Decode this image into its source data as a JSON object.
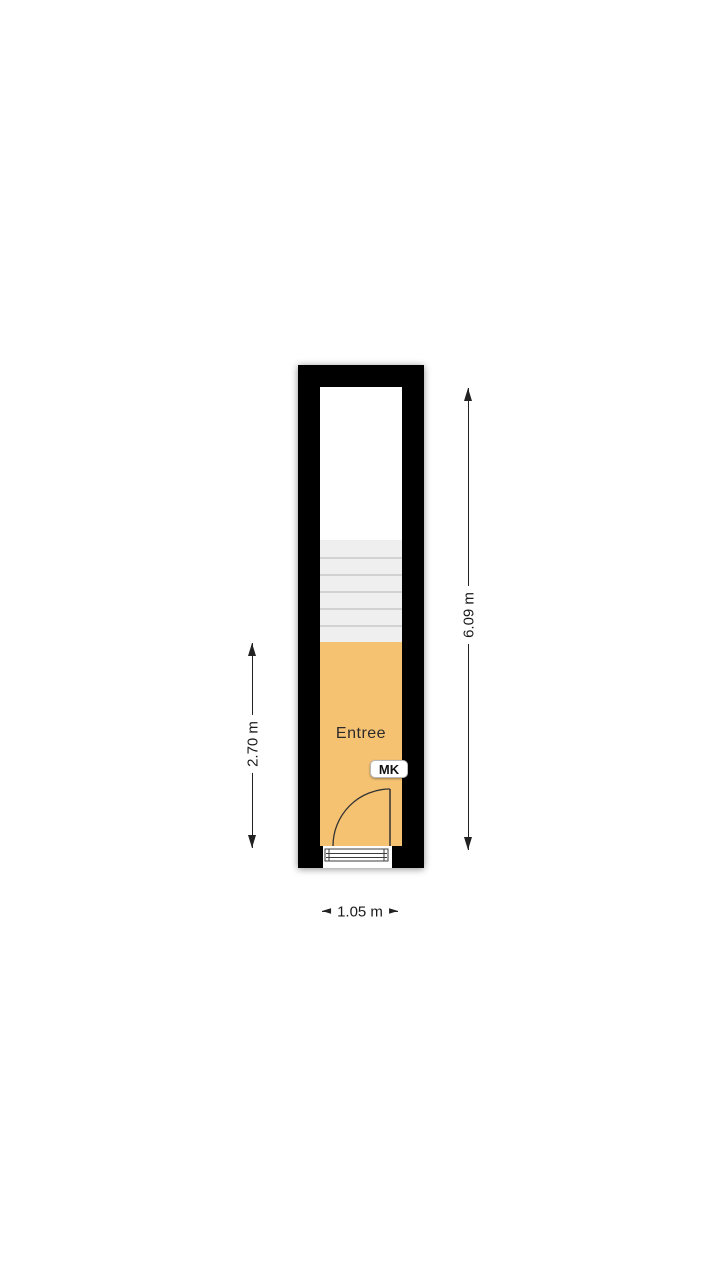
{
  "floorplan": {
    "room": {
      "label": "Entree"
    },
    "meter_closet": {
      "label": "MK"
    },
    "dimensions": {
      "overall_height": {
        "label": "6.09 m"
      },
      "entree_height": {
        "label": "2.70 m"
      },
      "width": {
        "label": "1.05 m"
      }
    },
    "stairs": {
      "treads": 6
    },
    "colors": {
      "room_fill": "#F5C272",
      "wall": "#000000",
      "stairs_fill": "#EFEFEF",
      "stair_line": "#D2D2D2",
      "dim_line": "#222222",
      "text": "#1A1A1A"
    }
  }
}
